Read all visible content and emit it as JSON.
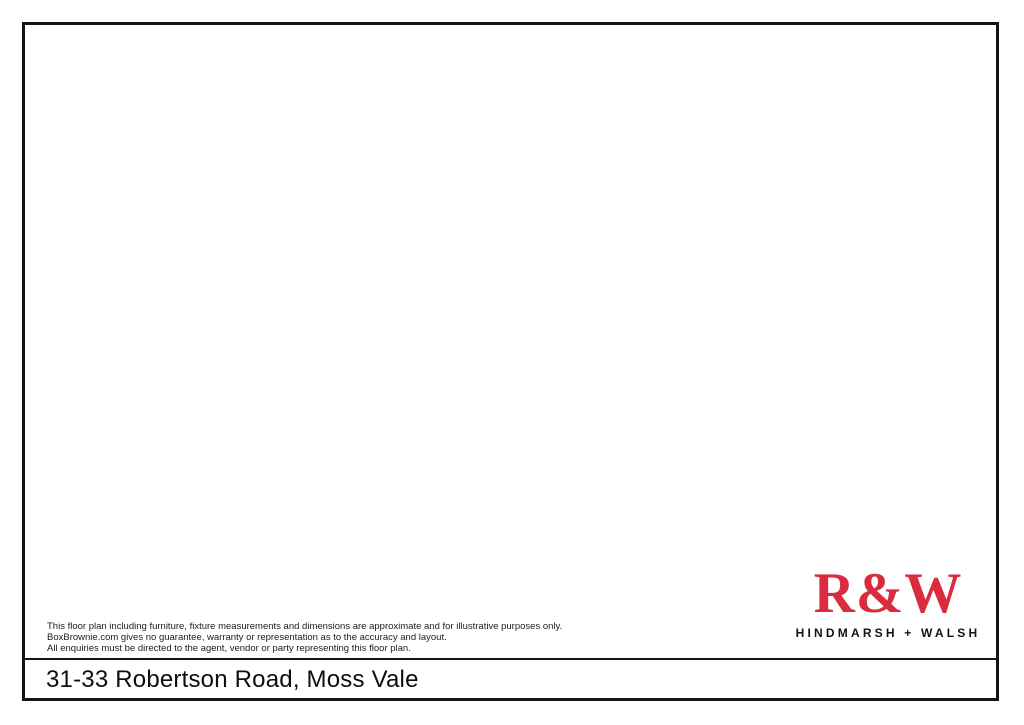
{
  "footer": {
    "disclaimer_lines": [
      "This floor plan including furniture, fixture measurements and dimensions are approximate and for illustrative purposes only.",
      "BoxBrownie.com gives no guarantee, warranty or representation as to the accuracy and layout.",
      "All enquiries must be directed to the agent, vendor or party representing this floor plan."
    ],
    "address": "31-33 Robertson Road, Moss Vale"
  },
  "brand": {
    "logo": "R&W",
    "tagline": "HINDMARSH + WALSH",
    "logo_color": "#d92c3e"
  },
  "plan": {
    "region_labels": [
      {
        "id": "driveway",
        "text": "DRIVEWAY",
        "x": 609,
        "y": 212,
        "size": 10,
        "ls": 1.2
      },
      {
        "id": "house",
        "text": "HOUSE",
        "x": 613,
        "y": 353,
        "size": 10,
        "ls": 1.0
      },
      {
        "id": "carport",
        "text": "CARPORT",
        "x": 444,
        "y": 437,
        "size": 9.5,
        "ls": 0.8
      },
      {
        "id": "garage",
        "text": "GARAGE",
        "x": 478,
        "y": 494,
        "size": 9.5,
        "ls": 0.8
      }
    ],
    "colors": {
      "lawn": "#b7d98f",
      "lawn_stroke": "#3f5220",
      "driveway": "#c9c9c9",
      "driveway_stroke": "#6f6f6f",
      "patio": "#d5bcbf",
      "patio_stroke": "#70595c",
      "house": "#f6f3da",
      "house_stroke": "#0d0d0d",
      "carport": "#9b979b",
      "garage": "#929092",
      "structure_stroke": "#111111",
      "boundary_line": "#8d9b77",
      "label_color": "#2e2e2e",
      "north": "#1a1a1a",
      "tree_dark": "#2b420e",
      "tree_base": "#7cab2e",
      "tree_base_b": "#88b63a",
      "tree_mid": "#9cc751",
      "tree_light": "#d8ec9d",
      "tree_bright": "#ebf6bd",
      "big_outer": "#5d8f1f",
      "big_ring": "#8abd35",
      "shadow": "rgba(30,40,10,0.36)"
    },
    "shapes": {
      "lot": {
        "x": 58,
        "y": 132,
        "w": 902,
        "h": 403
      },
      "driveway": [
        [
          500,
          174
        ],
        [
          640,
          188
        ],
        [
          703,
          197
        ],
        [
          770,
          200
        ],
        [
          848,
          184
        ],
        [
          905,
          178
        ],
        [
          960,
          184
        ],
        [
          960,
          202
        ],
        [
          898,
          210
        ],
        [
          860,
          213
        ],
        [
          800,
          221
        ],
        [
          735,
          230
        ],
        [
          700,
          239
        ],
        [
          686,
          252
        ],
        [
          640,
          250
        ],
        [
          599,
          246
        ],
        [
          599,
          470
        ],
        [
          610,
          500
        ],
        [
          648,
          531
        ],
        [
          517,
          531
        ],
        [
          517,
          513
        ],
        [
          470,
          513
        ],
        [
          470,
          398
        ],
        [
          500,
          398
        ]
      ],
      "patio": [
        [
          555,
          233
        ],
        [
          599,
          233
        ],
        [
          599,
          474
        ],
        [
          590,
          475
        ],
        [
          570,
          456
        ],
        [
          550,
          437
        ],
        [
          535,
          414
        ],
        [
          525,
          390
        ],
        [
          525,
          298
        ],
        [
          555,
          298
        ]
      ],
      "house": [
        [
          599,
          236
        ],
        [
          673,
          236
        ],
        [
          673,
          267
        ],
        [
          679,
          267
        ],
        [
          679,
          332
        ],
        [
          673,
          332
        ],
        [
          673,
          358
        ],
        [
          679,
          358
        ],
        [
          679,
          424
        ],
        [
          669,
          424
        ],
        [
          669,
          442
        ],
        [
          660,
          442
        ],
        [
          660,
          459
        ],
        [
          641,
          459
        ],
        [
          641,
          474
        ],
        [
          599,
          474
        ],
        [
          599,
          388
        ],
        [
          548,
          388
        ],
        [
          548,
          300
        ],
        [
          599,
          300
        ]
      ],
      "carport": {
        "x": 419,
        "y": 401,
        "w": 49,
        "h": 112
      },
      "garage": {
        "x": 439,
        "y": 466,
        "w": 78,
        "h": 48
      },
      "grass_strip": {
        "x": 420,
        "y": 514,
        "w": 97,
        "h": 18
      },
      "boundary_line": [
        [
          695,
          272
        ],
        [
          710,
          290
        ],
        [
          714,
          330
        ],
        [
          702,
          342
        ],
        [
          704,
          360
        ],
        [
          716,
          372
        ],
        [
          716,
          430
        ],
        [
          706,
          450
        ],
        [
          690,
          470
        ],
        [
          672,
          483
        ]
      ]
    },
    "north_arrow": {
      "shaft": "M406,353 C430,345 452,332 476,314",
      "head": [
        [
          492,
          304
        ],
        [
          466,
          311
        ],
        [
          475,
          325
        ]
      ],
      "glyph1": "M436,306 C453,312 451,331 436,337 C423,342 412,335 419,327 C424,321 433,324 429,331",
      "glyph2": "M438,308 C430,318 423,333 413,349 C409,355 403,356 399,352"
    },
    "trees": [
      [
        75,
        160,
        26,
        "A"
      ],
      [
        126,
        154,
        25,
        "C"
      ],
      [
        178,
        160,
        28,
        "B"
      ],
      [
        231,
        153,
        24,
        "A"
      ],
      [
        283,
        159,
        27,
        "C"
      ],
      [
        335,
        152,
        25,
        "B"
      ],
      [
        387,
        158,
        26,
        "A"
      ],
      [
        438,
        153,
        24,
        "C"
      ],
      [
        489,
        159,
        26,
        "B"
      ],
      [
        540,
        153,
        25,
        "A"
      ],
      [
        591,
        158,
        26,
        "C"
      ],
      [
        642,
        152,
        25,
        "B"
      ],
      [
        693,
        158,
        27,
        "A"
      ],
      [
        744,
        152,
        25,
        "C"
      ],
      [
        795,
        158,
        26,
        "B"
      ],
      [
        846,
        152,
        25,
        "C"
      ],
      [
        897,
        148,
        25,
        "A"
      ],
      [
        941,
        152,
        26,
        "B"
      ],
      [
        72,
        212,
        24,
        "B"
      ],
      [
        78,
        262,
        25,
        "C"
      ],
      [
        71,
        312,
        24,
        "A"
      ],
      [
        77,
        362,
        25,
        "B"
      ],
      [
        70,
        412,
        26,
        "A"
      ],
      [
        76,
        460,
        24,
        "B"
      ],
      [
        72,
        500,
        25,
        "C"
      ],
      [
        115,
        512,
        24,
        "B"
      ],
      [
        158,
        506,
        25,
        "A"
      ],
      [
        201,
        512,
        26,
        "B"
      ],
      [
        244,
        505,
        24,
        "C"
      ],
      [
        287,
        511,
        25,
        "A"
      ],
      [
        330,
        505,
        24,
        "B"
      ],
      [
        373,
        511,
        25,
        "A"
      ],
      [
        415,
        506,
        24,
        "B"
      ],
      [
        540,
        519,
        25,
        "A"
      ],
      [
        578,
        521,
        24,
        "B"
      ],
      [
        616,
        518,
        26,
        "C"
      ],
      [
        654,
        520,
        24,
        "A"
      ],
      [
        660,
        481,
        24,
        "B"
      ],
      [
        698,
        478,
        26,
        "A"
      ],
      [
        790,
        481,
        25,
        "A"
      ],
      [
        830,
        479,
        26,
        "B"
      ],
      [
        869,
        478,
        25,
        "A"
      ],
      [
        681,
        515,
        24,
        "C"
      ],
      [
        810,
        514,
        25,
        "A"
      ],
      [
        848,
        516,
        26,
        "B"
      ],
      [
        886,
        514,
        25,
        "A"
      ],
      [
        922,
        516,
        26,
        "C"
      ],
      [
        950,
        510,
        24,
        "A"
      ],
      [
        693,
        252,
        26,
        "B"
      ],
      [
        735,
        243,
        25,
        "A"
      ],
      [
        777,
        240,
        26,
        "B"
      ],
      [
        817,
        238,
        24,
        "C"
      ],
      [
        868,
        231,
        25,
        "A"
      ],
      [
        904,
        216,
        24,
        "C"
      ],
      [
        941,
        214,
        26,
        "B"
      ],
      [
        853,
        270,
        26,
        "B"
      ],
      [
        846,
        307,
        24,
        "C"
      ],
      [
        840,
        346,
        26,
        "A"
      ],
      [
        835,
        387,
        23,
        "B"
      ],
      [
        833,
        427,
        26,
        "A"
      ],
      [
        858,
        456,
        24,
        "C"
      ],
      [
        937,
        270,
        27,
        "B"
      ],
      [
        936,
        316,
        24,
        "A"
      ],
      [
        935,
        356,
        26,
        "B"
      ],
      [
        934,
        396,
        24,
        "A"
      ],
      [
        935,
        436,
        25,
        "B"
      ],
      [
        942,
        476,
        25,
        "C"
      ],
      [
        173,
        243,
        35,
        "C"
      ],
      [
        298,
        238,
        38,
        "B"
      ],
      [
        410,
        250,
        28,
        "A"
      ],
      [
        145,
        329,
        30,
        "A"
      ],
      [
        257,
        330,
        34,
        "C"
      ],
      [
        355,
        335,
        30,
        "B"
      ],
      [
        143,
        420,
        37,
        "B"
      ],
      [
        244,
        417,
        29,
        "A"
      ],
      [
        336,
        412,
        33,
        "C"
      ],
      [
        737,
        493,
        40,
        "D"
      ]
    ]
  }
}
